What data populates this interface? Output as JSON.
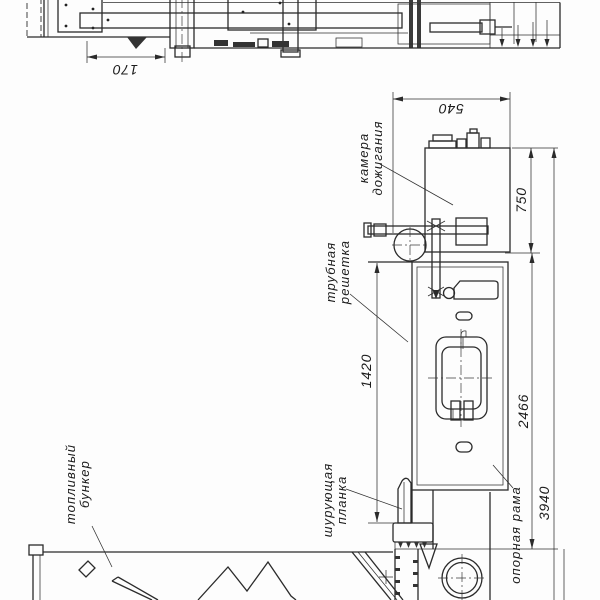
{
  "drawing_type": "boiler technical drawing (rotated view)",
  "labels": {
    "combustion_chamber_line1": "камера",
    "combustion_chamber_line2": "дожигания",
    "tube_grid_line1": "трубная",
    "tube_grid_line2": "решетка",
    "stoker_bar_line1": "шурующая",
    "stoker_bar_line2": "планка",
    "fuel_bunker_line1": "топливный",
    "fuel_bunker_line2": "бункер",
    "support_frame": "опорная рама"
  },
  "dimensions": {
    "top_view_offset": "170",
    "chamber_depth": "540",
    "chamber_height": "750",
    "grate_to_stoker": "1420",
    "boiler_body_length": "2466",
    "overall_length": "3940"
  },
  "colors": {
    "line": "#2b2b2b",
    "background": "#fdfdfd"
  }
}
